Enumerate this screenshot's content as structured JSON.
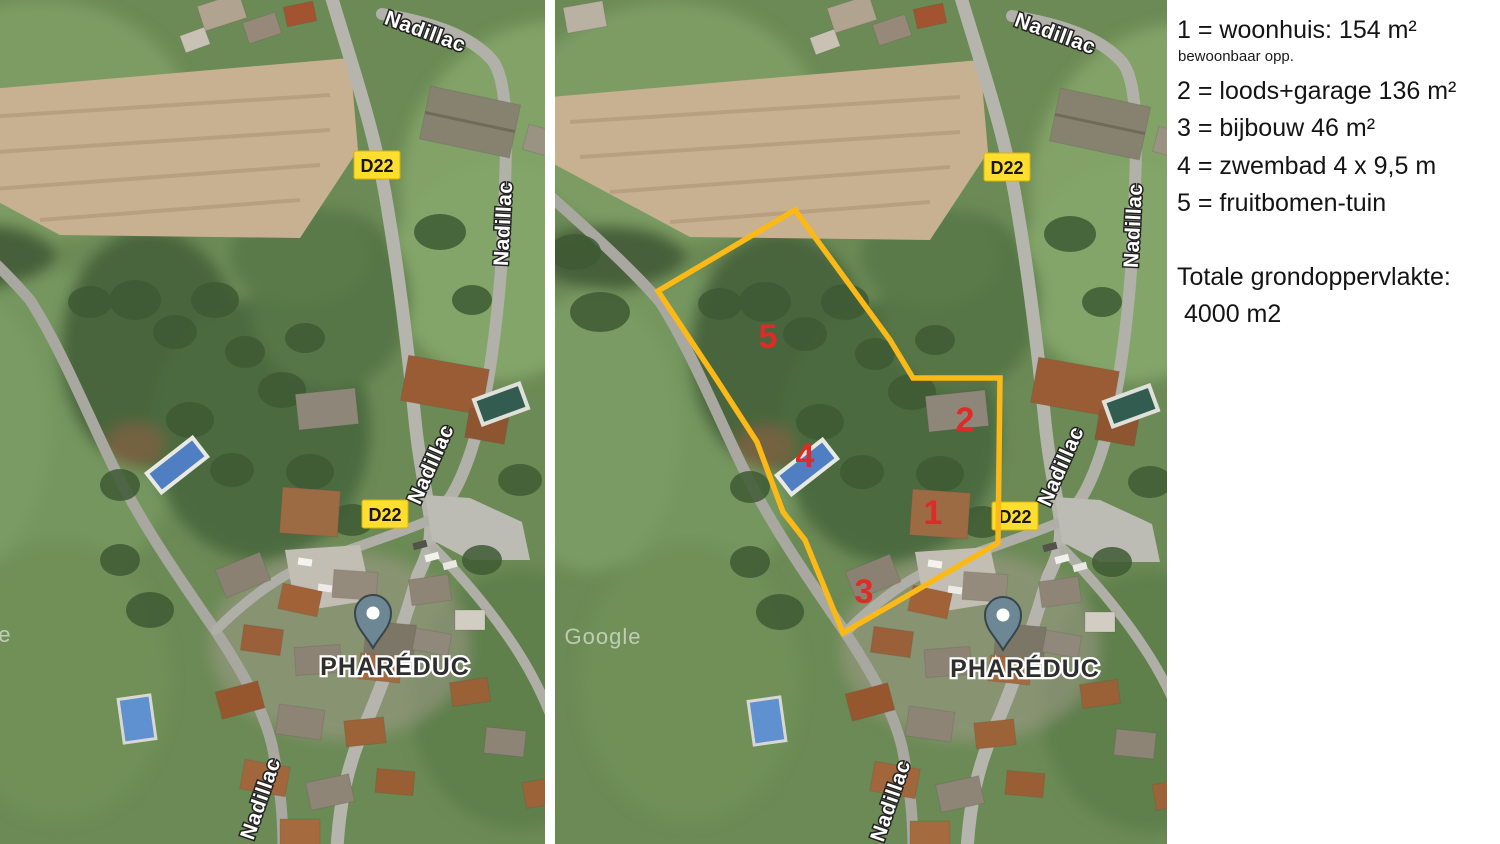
{
  "legend": {
    "items": [
      {
        "text": "1 = woonhuis: 154 m²",
        "sub": "bewoonbaar opp."
      },
      {
        "text": "2 = loods+garage 136 m²"
      },
      {
        "text": "3 = bijbouw 46 m²"
      },
      {
        "text": "4 = zwembad 4 x 9,5 m"
      },
      {
        "text": "5 = fruitbomen-tuin"
      }
    ],
    "total_label": "Totale grondoppervlakte:",
    "total_value": "4000 m2"
  },
  "map": {
    "road_label": "Nadillac",
    "route_badge": "D22",
    "place_label": "PHARÉDUC",
    "watermark": "Google"
  },
  "overlay": {
    "markers": [
      "1",
      "2",
      "3",
      "4",
      "5"
    ],
    "polygon_color": "#FBB917",
    "marker_color": "#DD2B27",
    "badge_color": "#FFDE30",
    "pin_color": "#6E8795"
  }
}
